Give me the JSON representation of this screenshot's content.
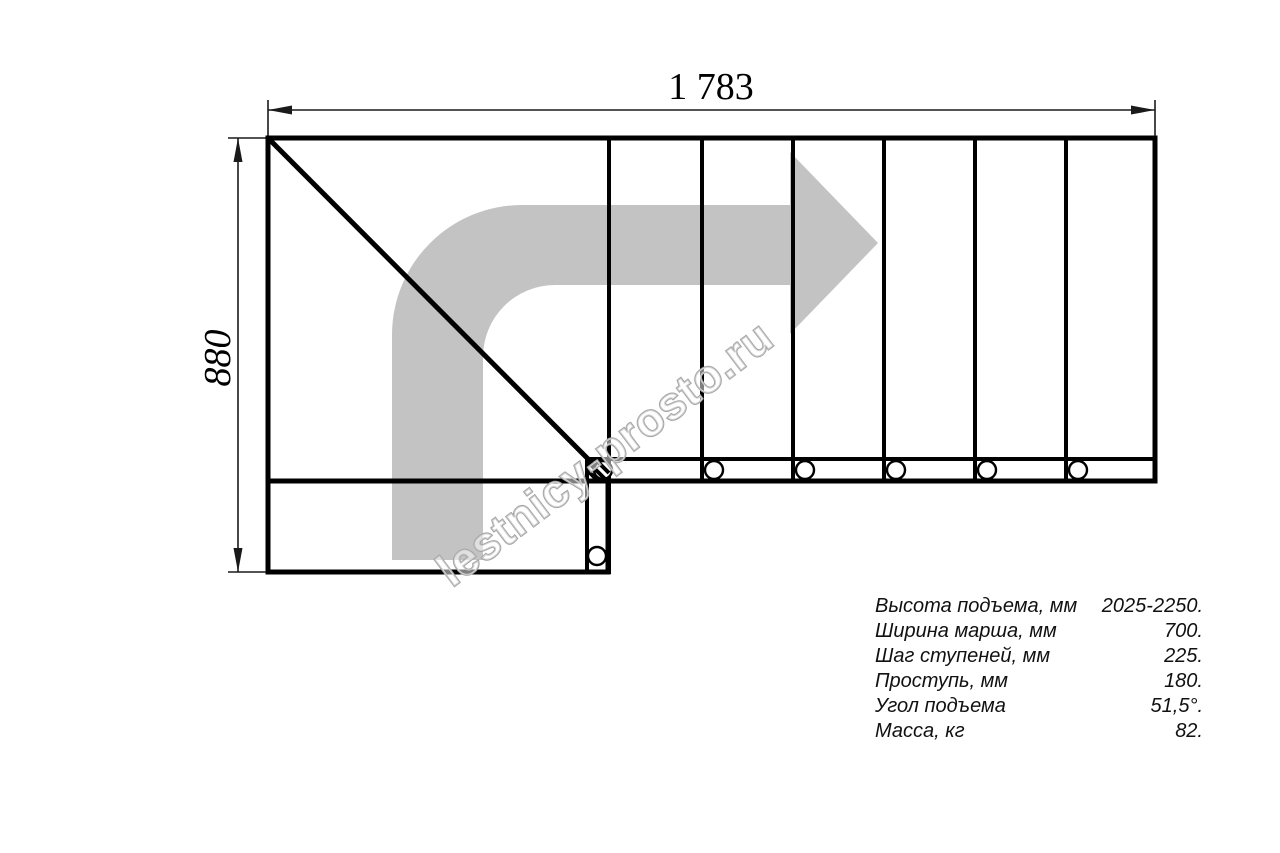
{
  "dimensions": {
    "width_label": "1 783",
    "height_label": "880"
  },
  "watermark": {
    "text": "lestnicy-prosto.ru"
  },
  "specs": {
    "rows": [
      {
        "label": "Высота подъема, мм",
        "value": "2025-2250."
      },
      {
        "label": "Ширина марша, мм",
        "value": "700."
      },
      {
        "label": "Шаг ступеней, мм",
        "value": "225."
      },
      {
        "label": "Проступь, мм",
        "value": "180."
      },
      {
        "label": "Угол подъема",
        "value": "51,5°."
      },
      {
        "label": "Масса, кг",
        "value": "82."
      }
    ]
  },
  "colors": {
    "line": "#000000",
    "dimension": "#1a1a1a",
    "arrow": "#c3c3c3",
    "watermark": "#a5a5a5"
  }
}
